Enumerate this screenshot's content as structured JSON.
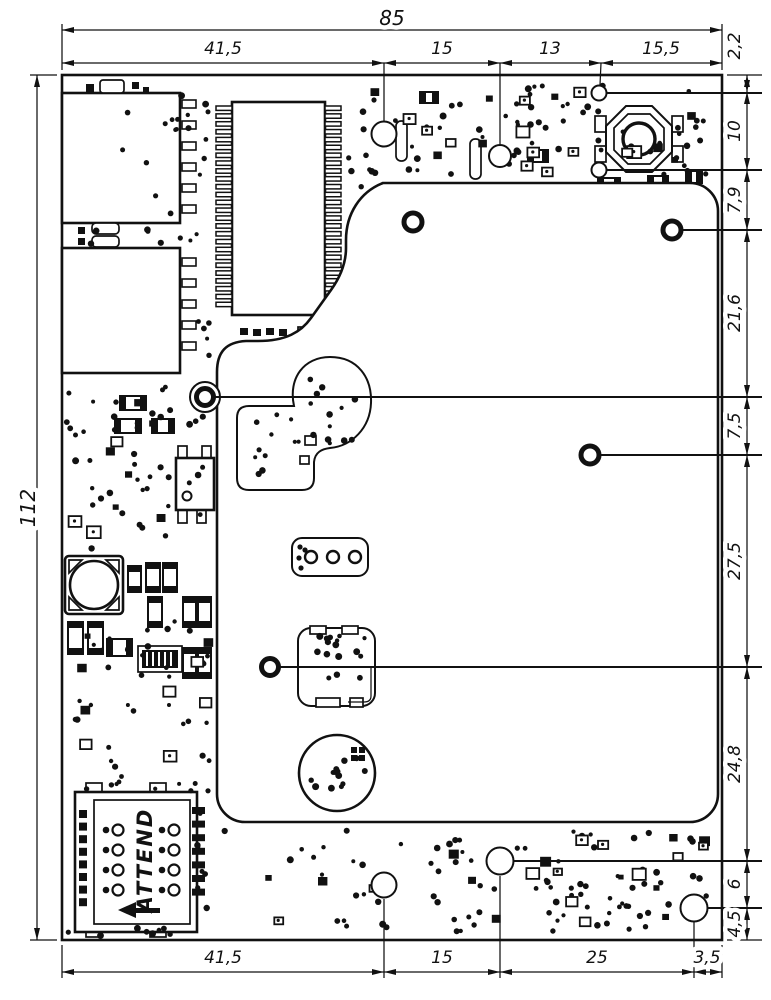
{
  "dimensions": {
    "top_total": "85",
    "top_segments": [
      "41,5",
      "15",
      "13",
      "15,5"
    ],
    "right_vertical_top": "2,2",
    "right_segments": [
      "10",
      "7,9",
      "21,6",
      "7,5",
      "27,5",
      "24,8",
      "6",
      "4,5"
    ],
    "left_total": "112",
    "bottom_segments": [
      "41,5",
      "15",
      "25",
      "3,5"
    ]
  },
  "components": {
    "sim_holder_label": "ATTEND"
  }
}
